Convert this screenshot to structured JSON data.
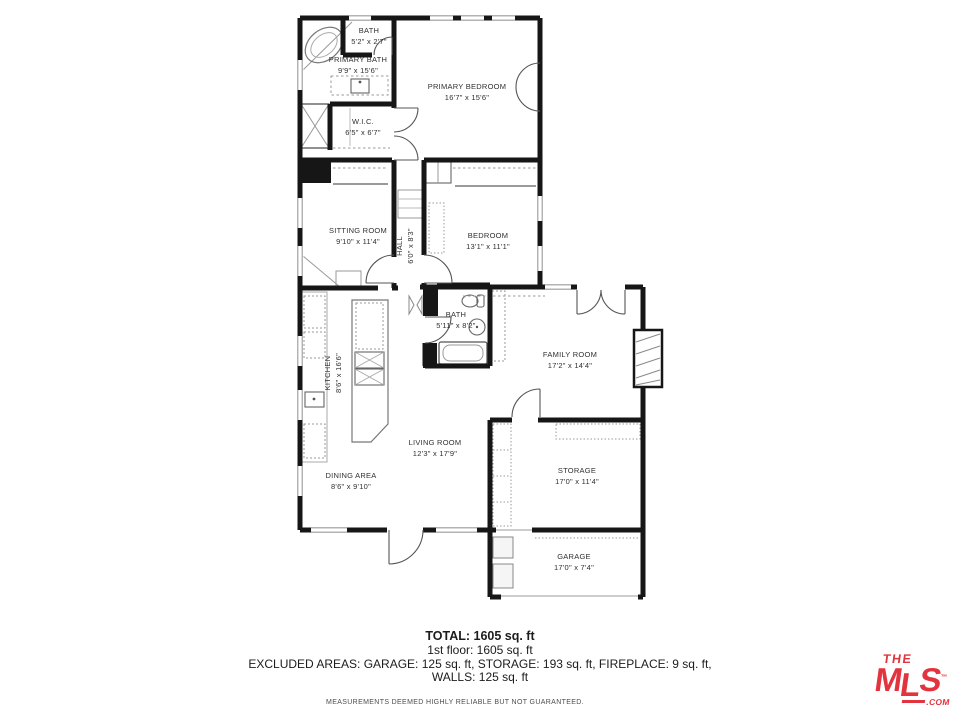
{
  "plan": {
    "rooms": [
      {
        "name": "BATH",
        "dims": "5'2\" x 2'7\""
      },
      {
        "name": "PRIMARY BATH",
        "dims": "9'9\" x 15'6\""
      },
      {
        "name": "PRIMARY BEDROOM",
        "dims": "16'7\" x 15'6\""
      },
      {
        "name": "W.I.C.",
        "dims": "6'5\" x 6'7\""
      },
      {
        "name": "SITTING ROOM",
        "dims": "9'10\" x 11'4\""
      },
      {
        "name": "HALL",
        "dims": "6'0\" x 8'3\""
      },
      {
        "name": "BEDROOM",
        "dims": "13'1\" x 11'1\""
      },
      {
        "name": "BATH",
        "dims": "5'11\" x 8'2\""
      },
      {
        "name": "FAMILY ROOM",
        "dims": "17'2\" x 14'4\""
      },
      {
        "name": "KITCHEN",
        "dims": "8'6\" x 16'6\""
      },
      {
        "name": "LIVING ROOM",
        "dims": "12'3\" x 17'9\""
      },
      {
        "name": "DINING AREA",
        "dims": "8'6\" x 9'10\""
      },
      {
        "name": "STORAGE",
        "dims": "17'0\" x 11'4\""
      },
      {
        "name": "GARAGE",
        "dims": "17'0\" x 7'4\""
      }
    ]
  },
  "summary": {
    "total": "TOTAL: 1605 sq. ft",
    "floor": "1st floor: 1605 sq. ft",
    "excluded": "EXCLUDED AREAS: GARAGE: 125 sq. ft, STORAGE: 193 sq. ft, FIREPLACE: 9 sq. ft,",
    "walls": "WALLS: 125 sq. ft",
    "disclaimer": "MEASUREMENTS DEEMED HIGHLY RELIABLE BUT NOT GUARANTEED."
  },
  "logo": {
    "the": "THE",
    "m": "M",
    "l": "L",
    "s": "S",
    "tm": "TM",
    "com": ".COM",
    "color": "#e2333e"
  }
}
